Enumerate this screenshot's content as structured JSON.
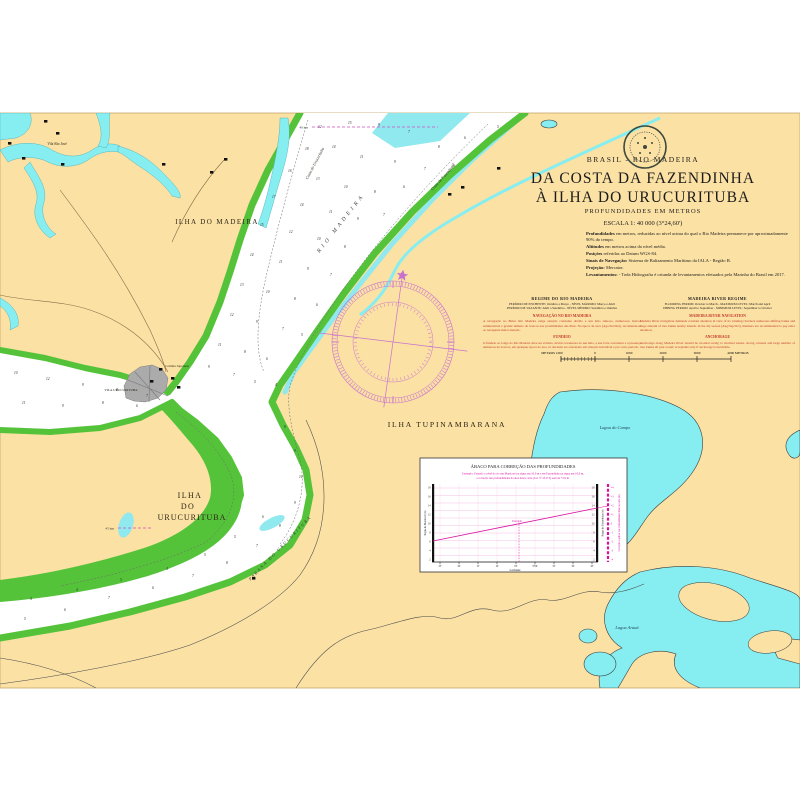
{
  "sheet": {
    "country": "BRASIL - RIO MADEIRA",
    "title1": "DA COSTA DA FAZENDINHA",
    "title2": "À ILHA DO URUCURITUBA",
    "subtitle": "PROFUNDIDADES EM METROS",
    "scale": "ESCALA 1: 40 000 (3°24,60')",
    "notes": [
      {
        "lead": "Profundidades",
        "text": "em metros, reduzidas ao nível acima do qual o Rio Madeira permanece por aproximadamente 90% do tempo."
      },
      {
        "lead": "Altitudes",
        "text": "em metros acima do nível médio."
      },
      {
        "lead": "Posições",
        "text": "referidas ao Datum WGS-84."
      },
      {
        "lead": "Sinais de Navegação:",
        "text": "Sistema de Balizamento Marítimo da IALA - Região B."
      },
      {
        "lead": "Projeção:",
        "text": "Mercator."
      },
      {
        "lead": "Levantamentos:",
        "text": "- Toda Hidrografia é oriunda de levantamentos efetuados pela Marinha do Brasil em 2017."
      }
    ],
    "columns": {
      "left": {
        "heading": "REGIME DO RIO MADEIRA",
        "line1": "PERÍODO DE ENCHENTE: Outubro a Março - NÍVEL MÁXIMO: Março e Abril",
        "line2": "PERÍODO DE VAZANTE: Abril a Setembro - NÍVEL MÍNIMO: Setembro e Outubro",
        "red1_title": "NAVEGAÇÃO NO RIO MADEIRA",
        "red1_text": "A navegação no Baixo Rio Madeira exige atenção constante devido a seu leito sinuoso, numerosos bancos submersíveis e grande número de troncos nas proximidades das ilhas. Na época de seca (Ago/Set/Out), recomenda-se ao navegante maior atenção.",
        "red2_title": "FUNDEIO",
        "red2_text": "O fundeio ao longo do Rio Madeira deve ser evitado, devido à natureza do seu leito, à sua forte correnteza e à presença numerosa de troncos, em qualquer época do ano, só devendo ser executado em situação inevitável e por curto período."
      },
      "right": {
        "heading": "MADEIRA RIVER REGIME",
        "line1": "FLOODING PERIOD: October to March - MAXIMUM LEVEL: March and April",
        "line2": "EBBING PERIOD: April to September - MINIMUM LEVEL: September to October",
        "red1_title": "MADEIRA RIVER NAVIGATION",
        "red1_text": "Madeira River navigation demands constant attention in view of its winding riverbed, numerous shifting banks and large amount of tree trunks nearby islands. In the dry season (Aug/Sep/Oct), mariners are recommended to pay extra attention.",
        "red2_title": "ANCHORAGE",
        "red2_text": "Anchorage along Madeira River should be avoided owing to riverbed nature, strong currents and large number of tree trunks all year round; acceptable only if anchorage is inevitable."
      }
    },
    "scale_bar": {
      "labels": [
        "METROS  1000",
        "0",
        "1000",
        "2000",
        "3000",
        "4000  METROS"
      ]
    }
  },
  "map": {
    "labels": {
      "ilha_madeira": "ILHA DO MADEIRA",
      "ilha_tupinambarana": "ILHA TUPINAMBARANA",
      "ilha_uru1": "ILHA",
      "ilha_uru2": "DO",
      "ilha_uru3": "URUCURITUBA",
      "vila_sao_jose": "Vila São José",
      "vila_urucurituba": "VILA URUCURITUBA",
      "colonia": "Colônia Japonesa",
      "costa_fazendinha": "Costa da Fazendinha",
      "costa_urucurituba": "Costa do Urucurituba",
      "rio_madeira": "RIO MADEIRA",
      "parana": "PARANÁ DO URUCURITUBA",
      "lagoa_campo": "Lagoa do Campo",
      "lagoa_araua": "Lagoa Arauá",
      "km40": "40 km",
      "km45": "45 km"
    },
    "colors": {
      "paper": "#fbe1a4",
      "channel": "#ffffff",
      "water_strip": "#8fe9ee",
      "lake": "#86eef0",
      "bank_green": "#55c33a",
      "rose_magenta": "#c872ce",
      "notes_red": "#c03a2b",
      "inset_magenta": "#d9119f"
    },
    "soundings": [
      [
        318,
        128,
        12
      ],
      [
        348,
        124,
        15
      ],
      [
        378,
        126,
        9
      ],
      [
        408,
        133,
        7
      ],
      [
        438,
        148,
        8
      ],
      [
        464,
        139,
        6
      ],
      [
        497,
        128,
        5
      ],
      [
        305,
        150,
        18
      ],
      [
        332,
        148,
        14
      ],
      [
        360,
        158,
        11
      ],
      [
        394,
        163,
        9
      ],
      [
        424,
        170,
        7
      ],
      [
        452,
        166,
        5
      ],
      [
        288,
        172,
        16
      ],
      [
        316,
        180,
        13
      ],
      [
        344,
        188,
        10
      ],
      [
        374,
        193,
        8
      ],
      [
        403,
        188,
        6
      ],
      [
        272,
        198,
        17
      ],
      [
        300,
        206,
        14
      ],
      [
        329,
        213,
        11
      ],
      [
        357,
        220,
        9
      ],
      [
        383,
        216,
        7
      ],
      [
        260,
        226,
        15
      ],
      [
        289,
        233,
        12
      ],
      [
        317,
        240,
        10
      ],
      [
        344,
        248,
        8
      ],
      [
        250,
        256,
        14
      ],
      [
        279,
        263,
        11
      ],
      [
        307,
        270,
        9
      ],
      [
        330,
        276,
        7
      ],
      [
        240,
        286,
        13
      ],
      [
        266,
        293,
        10
      ],
      [
        294,
        300,
        8
      ],
      [
        316,
        306,
        6
      ],
      [
        230,
        316,
        12
      ],
      [
        256,
        323,
        9
      ],
      [
        282,
        330,
        7
      ],
      [
        301,
        336,
        5
      ],
      [
        218,
        346,
        11
      ],
      [
        244,
        353,
        8
      ],
      [
        266,
        360,
        6
      ],
      [
        208,
        368,
        9
      ],
      [
        233,
        376,
        7
      ],
      [
        254,
        383,
        5
      ],
      [
        275,
        386,
        4
      ],
      [
        14,
        374,
        10
      ],
      [
        46,
        380,
        12
      ],
      [
        82,
        386,
        9
      ],
      [
        116,
        391,
        8
      ],
      [
        146,
        397,
        7
      ],
      [
        22,
        404,
        11
      ],
      [
        62,
        407,
        9
      ],
      [
        102,
        404,
        8
      ],
      [
        136,
        407,
        6
      ],
      [
        284,
        428,
        8
      ],
      [
        294,
        452,
        9
      ],
      [
        299,
        478,
        10
      ],
      [
        294,
        504,
        9
      ],
      [
        279,
        527,
        8
      ],
      [
        256,
        547,
        7
      ],
      [
        226,
        564,
        8
      ],
      [
        192,
        577,
        7
      ],
      [
        152,
        589,
        6
      ],
      [
        108,
        599,
        7
      ],
      [
        64,
        611,
        6
      ],
      [
        24,
        620,
        5
      ],
      [
        262,
        518,
        6
      ],
      [
        234,
        538,
        5
      ],
      [
        204,
        556,
        5
      ],
      [
        166,
        570,
        4
      ],
      [
        120,
        581,
        5
      ],
      [
        76,
        591,
        4
      ],
      [
        30,
        600,
        4
      ]
    ],
    "buildings": [
      [
        56,
        132
      ],
      [
        22,
        157
      ],
      [
        61,
        163
      ],
      [
        44,
        120
      ],
      [
        8,
        142
      ],
      [
        162,
        163
      ],
      [
        224,
        158
      ],
      [
        210,
        171
      ],
      [
        159,
        368
      ],
      [
        171,
        377
      ],
      [
        150,
        380
      ],
      [
        177,
        386
      ],
      [
        497,
        167
      ],
      [
        461,
        186
      ],
      [
        448,
        193
      ],
      [
        252,
        577
      ]
    ]
  },
  "inset": {
    "title": "ÁBACO PARA CORREÇÃO DAS PROFUNDIDADES",
    "example1": "Exemplo: Estando o nível do rio em Manicoré na régua em 10,0 m e em Fazendinha na régua em 10,0 m,",
    "example2": "a correção nas profundidades da área desta carta (Lat. 3° 25,0' S) será de +2,0 m.",
    "left_axis": "Régua de Manicoré (m)",
    "right_axis": "Régua de Fazendinha (m)",
    "corr_axis": "Correção a aplicar nas profundidades lidas na carta (m)",
    "x_label": "Latitude",
    "x_ticks": [
      "25'",
      "20'",
      "15'",
      "10'",
      "05'",
      "3°00'",
      "55'",
      "50'",
      "45'"
    ],
    "left_ticks": [
      "18",
      "16",
      "14",
      "12",
      "10",
      "8",
      "6",
      "4",
      "2"
    ],
    "right_ticks": [
      "18",
      "16",
      "14",
      "12",
      "10",
      "8",
      "6",
      "4",
      "2"
    ],
    "corr_ticks": [
      "+4",
      "+3",
      "+2",
      "+1",
      "0",
      "-1",
      "-2",
      "-3",
      "-4"
    ],
    "annotation": "Exemplo"
  }
}
